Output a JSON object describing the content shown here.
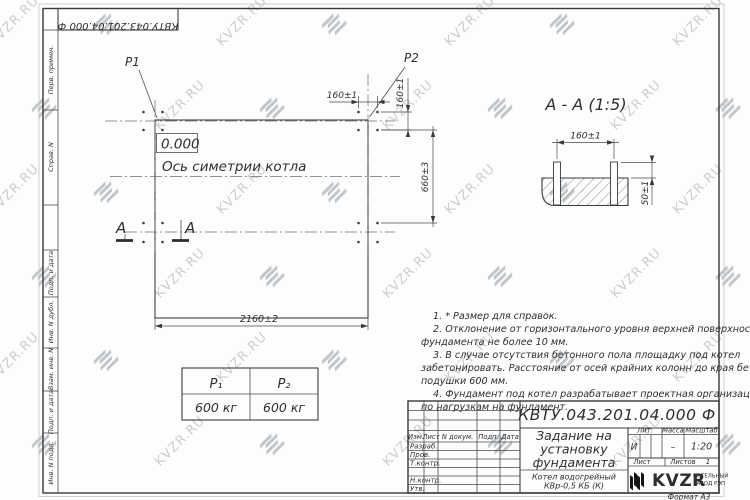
{
  "watermark": {
    "text": "KVZR.RU"
  },
  "top_stamp": {
    "doc_number": "КВТУ.043.201.04.000  Ф"
  },
  "left_margin": {
    "labels": [
      "Перв. примен.",
      "Справ. N",
      "Подп. и дата",
      "Инв. N дубл.",
      "Взам. инв. N",
      "Подп. и дата",
      "Инв. N подл."
    ]
  },
  "plan": {
    "p1_label": "P1",
    "p2_label": "P2",
    "level_mark": "0.000",
    "axis_label": "Ось симетрии котла",
    "dim_top_160": "160±1",
    "dim_right_160": "160±1",
    "dim_right_660": "660±3",
    "dim_bottom_2160": "2160±2",
    "section_letter": "А"
  },
  "section_view": {
    "title": "А - А (1:5)",
    "dim_width": "160±1",
    "dim_height": "50±1"
  },
  "load_table": {
    "col1_header": "P₁",
    "col2_header": "P₂",
    "col1_value": "600 кг",
    "col2_value": "600 кг"
  },
  "notes": {
    "lines": [
      "1. * Размер для справок.",
      "2. Отклонение от горизонтального уровня верхней поверхности",
      "фундамента не более 10 мм.",
      "3. В случае отсутствия бетонного пола площадку под котел",
      "забетонировать. Расстояние от осей крайних колонн до края бетонной",
      "подушки 600 мм.",
      "4. Фундамент под котел разрабатывает проектная организация",
      "по нагрузкам на фундамент."
    ]
  },
  "title_block": {
    "doc_number": "КВТУ.043.201.04.000  Ф",
    "title_lines": [
      "Задание на",
      "установку",
      "фундамента"
    ],
    "product_lines": [
      "Котел водогрейный",
      "КВр-0,5 КБ (К)"
    ],
    "header_cells": [
      "Изм.",
      "Лист",
      "N докум.",
      "Подп.",
      "Дата"
    ],
    "row_labels": [
      "Разраб.",
      "Пров.",
      "Т.контр.",
      "Н.контр.",
      "Утв."
    ],
    "lit_label": "Лит.",
    "lit_value": "И",
    "mass_label": "Масса",
    "mass_value": "–",
    "scale_label": "Масштаб",
    "scale_value": "1:20",
    "sheet_label": "Лист",
    "sheets_label": "Листов",
    "sheets_value": "1",
    "logo_text": "KVZR",
    "logo_caption_lines": [
      "КОТЕЛЬНЫЙ",
      "ЗАВОД РЭП"
    ],
    "format_note": "Формат А3"
  }
}
